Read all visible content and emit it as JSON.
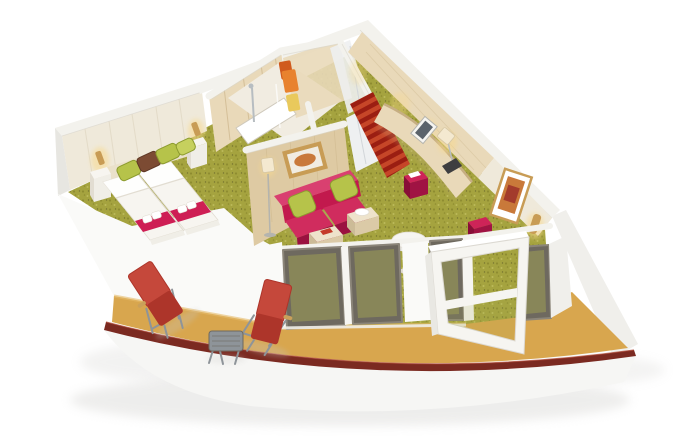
{
  "scene": {
    "label": "3D cutaway rendering of a ship balcony suite: bedroom with twin beds, bathroom with shower, entry corridor with striped red carpet, living area with magenta sofa and desk, glass sliding doors and curved balcony with red sun loungers"
  },
  "objects": [
    "twin-beds-with-white-duvets",
    "magenta-bed-runners",
    "folded-white-towels",
    "green-accent-pillows",
    "brown-accent-pillow",
    "nightstands",
    "wall-sconces",
    "cream-panelled-headboard-wall",
    "green-speckled-carpet",
    "bathroom-with-shower",
    "hanging-orange-towels",
    "wardrobe",
    "entry-corridor-striped-red-carpet",
    "mirrored-closet-panel",
    "curved-vanity-desk",
    "desk-lamp",
    "framed-artwork",
    "magenta-ottomans",
    "magenta-two-seat-sofa",
    "cream-cube-coffee-tables",
    "round-pedestal-side-table",
    "floor-lamp",
    "glass-sliding-door-wall",
    "open-balcony-door",
    "tan-balcony-deck",
    "dark-red-curved-railing",
    "red-sun-loungers",
    "grey-bistro-table",
    "white-ship-hull"
  ],
  "colors": {
    "bg": "#ffffff",
    "shadow": "#c7c6c2",
    "wallTop": "#f3f2ed",
    "wallEdge": "#d9d5cc",
    "backWall": "#efe9da",
    "panelLine": "#e0d7c3",
    "headboard": "#eae1cb",
    "whiteWall": "#fafaf8",
    "whiteWallShade": "#e9e8e3",
    "leftWallShade": "#e7e6e1",
    "woodLight": "#e9d9b9",
    "wood": "#decaa3",
    "woodDark": "#c6ae82",
    "grain": "#d2bd95",
    "bathFloor": "#f1ece1",
    "trayWhite": "#ffffff",
    "trayEdge": "#cfc9bc",
    "chrome": "#b7bdc1",
    "towelOrange": "#e8822e",
    "towelOrangeDark": "#d05a1d",
    "towelYellow": "#e9c95c",
    "closet": "#eef0f1",
    "closetSeam": "#d2d6d9",
    "carpet": "#a5a33f",
    "carpetDot1": "#8e8c30",
    "carpetDot2": "#bcba5a",
    "carpetDot3": "#767430",
    "corridorRed": "#9b1e12",
    "corridorStripe": "#c64628",
    "runner": "#ce1e54",
    "bedWhite": "#f7f5f0",
    "bedShade": "#e2ddd2",
    "footboard": "#f0eee7",
    "pillowGreen": "#b6c34a",
    "pillowGreenLight": "#c6d05e",
    "pillowGreenDark": "#8c9b2e",
    "pillowBrown": "#7c4b33",
    "pillowBrownDark": "#5f3826",
    "sofa": "#c2194d",
    "sofaLight": "#d94070",
    "sofaSeat": "#d02c5e",
    "sofaDark": "#9a1140",
    "stool": "#ce2458",
    "stoolDark": "#a01343",
    "stoolSide": "#880e37",
    "tableCream": "#eee3cb",
    "tableCreamDark": "#dbcaa7",
    "tableCreamSide": "#ccbb97",
    "tileRed": "#c43b2a",
    "gold": "#c89c55",
    "artOrange": "#c9793a",
    "artRed": "#a33b2c",
    "frameWhite": "#f6f5f1",
    "glassFrame": "#6e695f",
    "glassFrameLight": "#8b8579",
    "glassTint": "#a9ab52",
    "deck": "#d8a64e",
    "deckLight": "#e6bb69",
    "cap": "#7b2a21",
    "capLight": "#a8402d",
    "hull": "#f6f6f4",
    "hullShade": "#f0efeb",
    "hullEdge": "#dcd9d2",
    "lounger": "#c5483b",
    "loungerDark": "#ad352a",
    "frameGray": "#8e9499",
    "woodAccent": "#caa05a",
    "tvDark": "#3e3e40",
    "screen": "#5b636b",
    "glow": "#f8d98c",
    "lampShade": "#f4e9d0",
    "lampShadeEdge": "#d6c7a5",
    "white": "#ffffff",
    "grayLine": "#b4b4ae"
  }
}
